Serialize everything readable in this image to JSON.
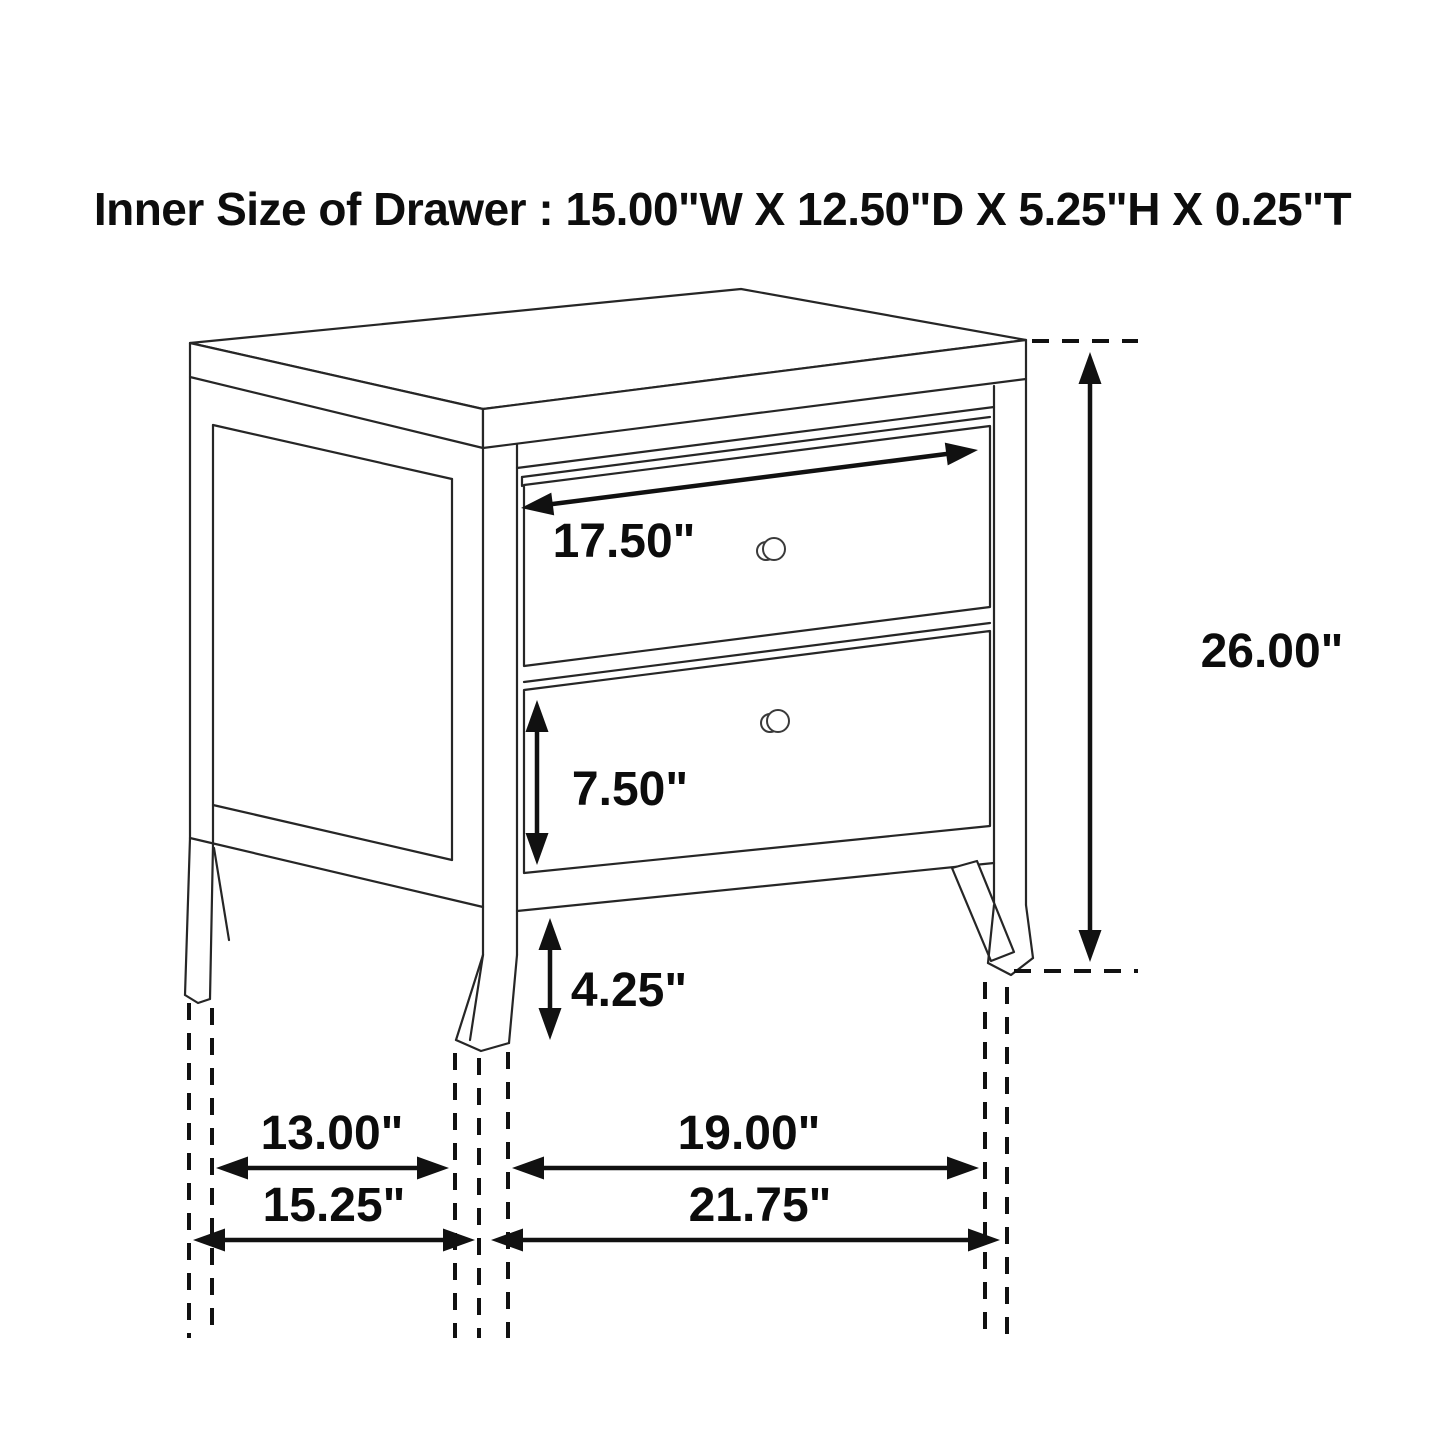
{
  "title": "Inner Size of Drawer : 15.00\"W X 12.50\"D X 5.25\"H X 0.25\"T",
  "diagram": {
    "subject": "two-drawer nightstand dimension drawing",
    "dims": {
      "drawer_front_width": "17.50\"",
      "overall_height": "26.00\"",
      "bottom_drawer_height": "7.50\"",
      "leg_clearance": "4.25\"",
      "side_leg_inner_span": "13.00\"",
      "front_leg_inner_span": "19.00\"",
      "side_overall_depth": "15.25\"",
      "front_overall_width": "21.75\""
    }
  }
}
